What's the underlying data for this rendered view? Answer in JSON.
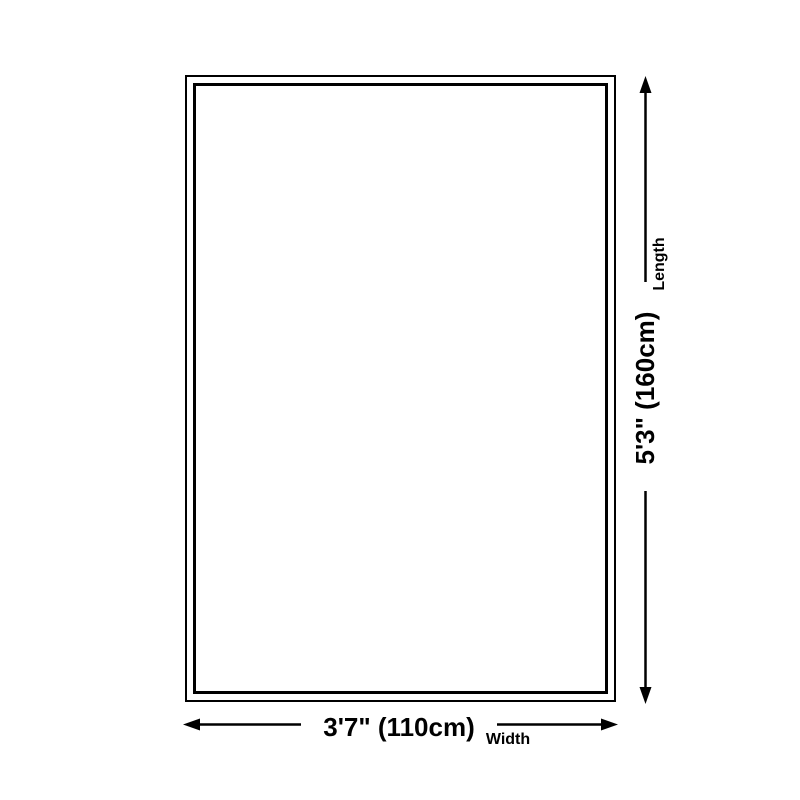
{
  "diagram": {
    "length_value": "5'3\" (160cm)",
    "length_label": "Length",
    "width_value": "3'7\" (110cm)",
    "width_label": "Width",
    "colors": {
      "line": "#000000",
      "text": "#000000",
      "background": "#ffffff"
    }
  }
}
